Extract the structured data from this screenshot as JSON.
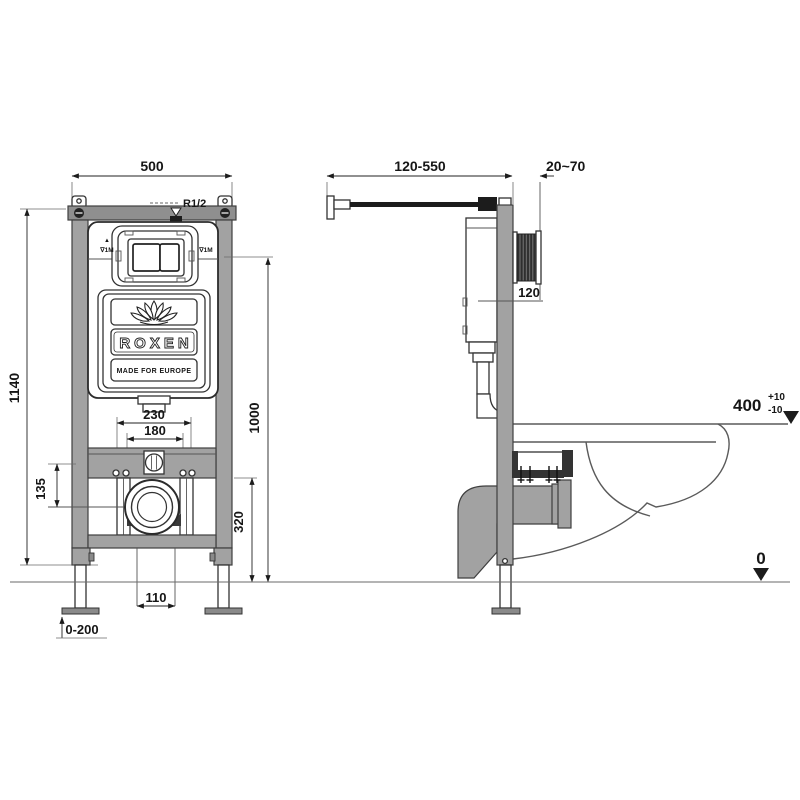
{
  "colors": {
    "frame_gray": "#a2a2a2",
    "dark": "#1c1c1c",
    "line": "#4a4a4a",
    "background": "#ffffff"
  },
  "front_view": {
    "dimensions": {
      "width": "500",
      "height": "1140",
      "plate_height": "1000",
      "outlet_height": "320",
      "outer_fixing": "230",
      "inner_fixing": "180",
      "bar_to_outlet": "135",
      "floor_outlet": "110",
      "leg_adjustment": "0-200"
    },
    "labels": {
      "inlet_thread": "R1/2",
      "water_mark_left": "∇1M",
      "water_mark_right": "∇1M",
      "water_mark_arrow": "▲"
    },
    "brand": {
      "name": "ROXEN",
      "tagline": "MADE FOR EUROPE"
    }
  },
  "side_view": {
    "dimensions": {
      "inlet_depth_range": "120-550",
      "finish_wall_range": "20~70",
      "plate_height": "120",
      "bowl_height": "400",
      "bowl_height_tol_plus": "+10",
      "bowl_height_tol_minus": "-10",
      "floor_level": "0"
    }
  }
}
